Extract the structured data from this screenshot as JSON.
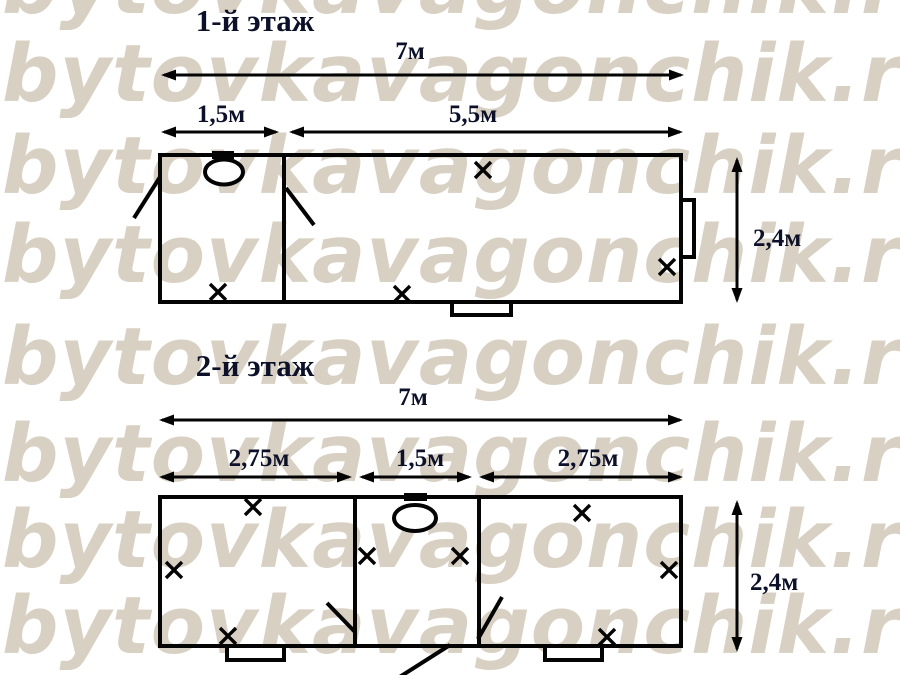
{
  "watermark": {
    "text": "bytovkavagonchik.ru",
    "color": "#d8d0c3"
  },
  "diagram": {
    "line_color": "#040404",
    "dim_text_color": "#0c1028",
    "floor1": {
      "title": "1-й этаж",
      "dim_total": "7м",
      "dim_room_left": "1,5м",
      "dim_room_right": "5,5м",
      "dim_height": "2,4м"
    },
    "floor2": {
      "title": "2-й этаж",
      "dim_total": "7м",
      "dim_room_left": "2,75м",
      "dim_room_middle": "1,5м",
      "dim_room_right": "2,75м",
      "dim_height": "2,4м"
    }
  }
}
